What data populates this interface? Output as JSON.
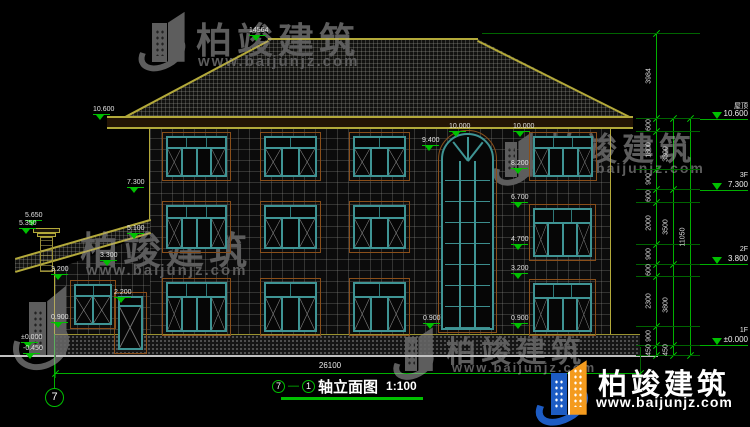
{
  "title_block": {
    "axis_start": "7",
    "axis_end": "1",
    "name": "轴立面图",
    "scale": "1:100",
    "separator": "—"
  },
  "axis_bubble": "7",
  "dimensions": {
    "bottom_total": "26100",
    "right_inner": [
      "3984",
      "600",
      "1800",
      "900",
      "600",
      "2000",
      "900",
      "600",
      "2300",
      "900",
      "450"
    ],
    "right_middle": [
      "3300",
      "3500",
      "3800",
      "450"
    ],
    "right_outer": [
      "11050"
    ]
  },
  "levels": [
    {
      "label": "屋顶",
      "value": "10.600"
    },
    {
      "label": "3F",
      "value": "7.300"
    },
    {
      "label": "2F",
      "value": "3.800"
    },
    {
      "label": "1F",
      "value": "±0.000"
    }
  ],
  "elevation_markers": [
    "14564",
    "10.600",
    "7.300",
    "5.650",
    "5.350",
    "5.100",
    "3.300",
    "3.200",
    "2.200",
    "0.900",
    "±0.000",
    "-0.450",
    "10.000",
    "10.000",
    "9.400",
    "8.200",
    "6.700",
    "4.700",
    "3.200",
    "0.900",
    "0.900"
  ],
  "watermark": {
    "brand": "柏竣建筑",
    "url": "www.baijunjz.com"
  },
  "footer_logo": {
    "brand": "柏竣建筑",
    "url": "www.baijunjz.com"
  },
  "colors": {
    "cad_green": "#00c000",
    "line_yellow": "#b3a93a",
    "frame_teal": "#3f9494",
    "surround_brown": "#8a4f1a",
    "logo_blue": "#1d5cc4",
    "logo_orange": "#f49b1e"
  }
}
